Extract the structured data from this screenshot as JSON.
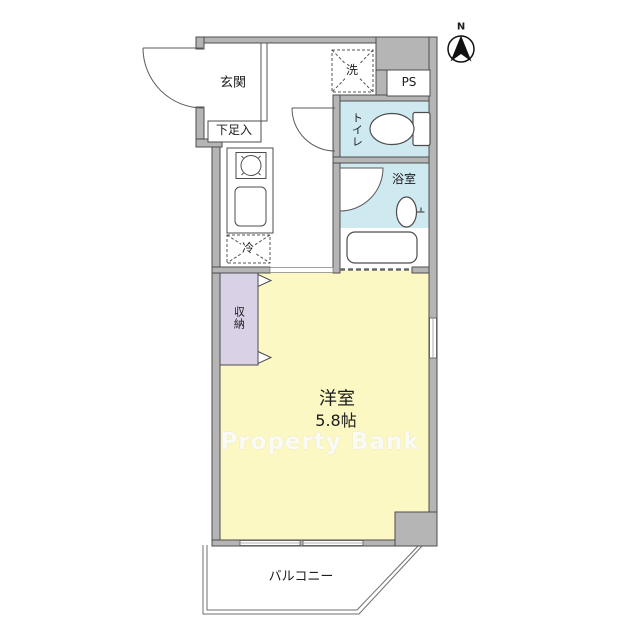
{
  "floorplan": {
    "compass": {
      "north_label": "N"
    },
    "watermark": "Property Bank",
    "rooms": {
      "entrance": {
        "label": "玄関"
      },
      "shoe_box": {
        "label": "下足入"
      },
      "laundry": {
        "label": "洗"
      },
      "pipe_space": {
        "label": "PS"
      },
      "toilet": {
        "label": "トイレ"
      },
      "bathroom": {
        "label": "浴室"
      },
      "refrigerator": {
        "label": "冷"
      },
      "closet": {
        "label": "収納"
      },
      "main_room": {
        "label": "洋室",
        "size": "5.8帖"
      },
      "balcony": {
        "label": "バルコニー"
      }
    },
    "colors": {
      "main_room_yellow": "#fbf8c3",
      "wet_area_blue": "#cfe9f1",
      "closet_lavender": "#d9d1e6",
      "wall_gray": "#b5b5b5",
      "outline_dark": "#4d4d4d"
    }
  }
}
